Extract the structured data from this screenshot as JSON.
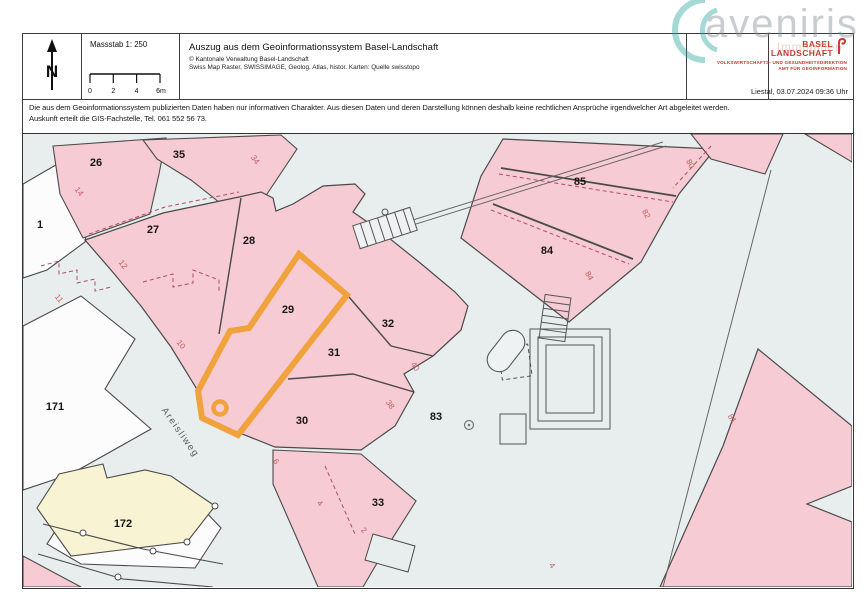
{
  "header": {
    "north_label": "N",
    "scale": {
      "label": "Massstab 1: 250",
      "ticks": [
        "0",
        "2",
        "4",
        "6m"
      ]
    },
    "title": "Auszug aus dem Geoinformationssystem Basel-Landschaft",
    "copyright": "© Kantonale Verwaltung Basel-Landschaft",
    "sources": "Swiss Map Raster, SWISSIMAGE, Geolog. Atlas, histor. Karten: Quelle swisstopo",
    "org": {
      "line1": "BASEL",
      "line2": "LANDSCHAFT",
      "dept1": "VOLKSWIRTSCHAFTS- UND GESUNDHEITSDIREKTION",
      "dept2": "AMT FÜR GEOINFORMATION"
    },
    "datestamp": "Liestal, 03.07.2024 09:36 Uhr"
  },
  "watermark": {
    "text": "aveniris",
    "subtext": "Immobilien"
  },
  "disclaimer": {
    "line1": "Die aus dem Geoinformationssystem publizierten Daten haben nur informativen Charakter. Aus diesen Daten und deren Darstellung können deshalb keine rechtlichen Ansprüche irgendwelcher Art abgeleitet werden.",
    "line2": "Auskunft erteilt die GIS-Fachstelle, Tel. 061 552 56 73."
  },
  "map": {
    "street_label": "Areisliweg",
    "highlighted_parcel": "29",
    "parcel_labels": [
      {
        "text": "26",
        "x": 73,
        "y": 32
      },
      {
        "text": "35",
        "x": 156,
        "y": 24
      },
      {
        "text": "1",
        "x": 17,
        "y": 94
      },
      {
        "text": "27",
        "x": 130,
        "y": 99
      },
      {
        "text": "28",
        "x": 226,
        "y": 110
      },
      {
        "text": "29",
        "x": 265,
        "y": 179
      },
      {
        "text": "32",
        "x": 365,
        "y": 193
      },
      {
        "text": "31",
        "x": 311,
        "y": 222
      },
      {
        "text": "30",
        "x": 279,
        "y": 290
      },
      {
        "text": "83",
        "x": 413,
        "y": 286
      },
      {
        "text": "33",
        "x": 355,
        "y": 372
      },
      {
        "text": "171",
        "x": 32,
        "y": 276
      },
      {
        "text": "172",
        "x": 100,
        "y": 393
      },
      {
        "text": "84",
        "x": 524,
        "y": 120
      },
      {
        "text": "85",
        "x": 557,
        "y": 51
      }
    ],
    "house_numbers": [
      {
        "text": "14",
        "x": 54,
        "y": 59,
        "rot": 52
      },
      {
        "text": "12",
        "x": 98,
        "y": 132,
        "rot": 52
      },
      {
        "text": "11",
        "x": 34,
        "y": 166,
        "rot": 52
      },
      {
        "text": "10",
        "x": 156,
        "y": 212,
        "rot": 52
      },
      {
        "text": "34",
        "x": 230,
        "y": 27,
        "rot": 55
      },
      {
        "text": "40",
        "x": 390,
        "y": 234,
        "rot": 55
      },
      {
        "text": "38",
        "x": 365,
        "y": 272,
        "rot": 55
      },
      {
        "text": "6",
        "x": 251,
        "y": 329,
        "rot": 55
      },
      {
        "text": "4",
        "x": 295,
        "y": 371,
        "rot": 47
      },
      {
        "text": "2",
        "x": 339,
        "y": 398,
        "rot": 47
      },
      {
        "text": "80",
        "x": 665,
        "y": 31,
        "rot": 62
      },
      {
        "text": "82",
        "x": 621,
        "y": 81,
        "rot": 62
      },
      {
        "text": "84",
        "x": 564,
        "y": 143,
        "rot": 62
      },
      {
        "text": "81",
        "x": 707,
        "y": 286,
        "rot": 55
      },
      {
        "text": "4",
        "x": 527,
        "y": 433,
        "rot": 55
      }
    ]
  },
  "colors": {
    "highlight_orange": "#F0A23C",
    "parcel_pink": "#F7CBD3",
    "road_gray": "#E8EDEE",
    "parcel_white": "#FCFCFD",
    "parcel_yellow": "#F8F4D3",
    "house_number_red": "#C25B5B",
    "org_red": "#C9372E",
    "watermark_teal": "#2AA5A0"
  }
}
